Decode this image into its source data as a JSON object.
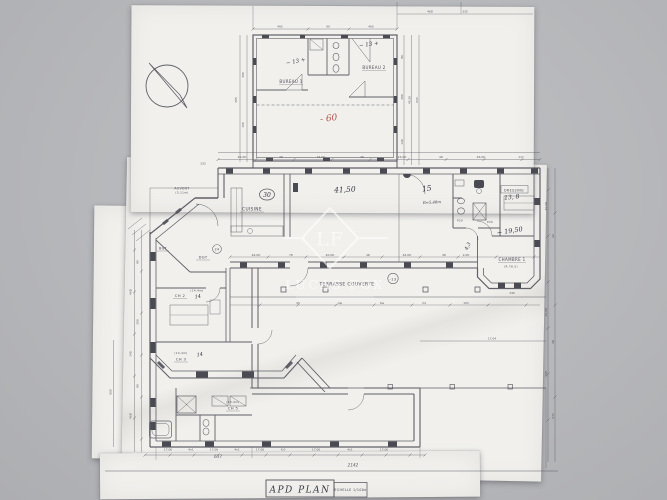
{
  "photo": {
    "background_color": "#b6b7ba",
    "paper_color": "#f1f0ed"
  },
  "ink": {
    "plan": "#54545c",
    "pen": "#333741",
    "red": "#b0544b"
  },
  "watermark": {
    "monogram": "LF",
    "brand": "LUCAS FOX"
  },
  "title_block": {
    "name": "APD  PLAN",
    "scale": "ECHELLE 1/100e"
  },
  "rooms": {
    "bureau1": "BUREAU 1",
    "bureau2": "BUREAU 2",
    "auvent": "AUVENT",
    "auvent_area": "(5,11m)",
    "cuisine": "CUISINE",
    "bgt": "BGT",
    "dgt": "DGT",
    "ch2": "CH 2",
    "ch2_area": "(14,4m)",
    "ch3": "CH 3",
    "ch3_area": "(14,4m)",
    "ch5": "CH 5",
    "ch5_area": "(13,4m)",
    "dressing": "DRESSING",
    "chambre1": "CHAMBRE 1",
    "chambre1_area": "(R.78,5)",
    "terrasse": "TERRASSE  COUVERTE",
    "p20": "P20"
  },
  "annotations": {
    "bureau1_area": "~ 13 +",
    "bureau2_area": "~ 13 +",
    "red_total": "- 60",
    "hall_circle": "30",
    "hall_total": "41,50",
    "bath_label": "15",
    "bath_width": "B=5,48m",
    "dressing_val": "13, 8",
    "right_total": "~ 19,50",
    "small_val": "4,3",
    "ch2_val": "14",
    "ch3_val": "14",
    "level_val": "-13",
    "entry_val": "24"
  },
  "dimensions": [
    {
      "t": "465",
      "x": 280,
      "y": 27.5
    },
    {
      "t": "90",
      "x": 328,
      "y": 27.5
    },
    {
      "t": "460",
      "x": 371,
      "y": 27.5
    },
    {
      "t": "335",
      "x": 465,
      "y": 12.5
    },
    {
      "t": "46D",
      "x": 430,
      "y": 12.5
    },
    {
      "t": "300",
      "x": 244,
      "y": 75,
      "r": -90
    },
    {
      "t": "150",
      "x": 244,
      "y": 125,
      "r": -90
    },
    {
      "t": "305",
      "x": 237,
      "y": 100,
      "r": -90
    },
    {
      "t": "90",
      "x": 403,
      "y": 57,
      "r": -90
    },
    {
      "t": "300",
      "x": 403,
      "y": 97,
      "r": -90
    },
    {
      "t": "140",
      "x": 403,
      "y": 142,
      "r": -90
    },
    {
      "t": "45,50",
      "x": 410.5,
      "y": 100,
      "r": -90
    },
    {
      "t": "643",
      "x": 418,
      "y": 100,
      "r": -90
    },
    {
      "t": "333",
      "x": 203,
      "y": 164.5
    },
    {
      "t": "46,0D",
      "x": 242,
      "y": 157.8
    },
    {
      "t": "4D",
      "x": 281,
      "y": 157.8
    },
    {
      "t": "34,0D",
      "x": 321,
      "y": 157.8
    },
    {
      "t": "4D",
      "x": 362,
      "y": 157.8
    },
    {
      "t": "24,0D",
      "x": 402,
      "y": 157.8
    },
    {
      "t": "4D",
      "x": 441,
      "y": 157.8
    },
    {
      "t": "46,0D",
      "x": 481,
      "y": 157.8
    },
    {
      "t": "117",
      "x": 521,
      "y": 157.8
    },
    {
      "t": "46,0D",
      "x": 256,
      "y": 255.8
    },
    {
      "t": "7D",
      "x": 291,
      "y": 255.8
    },
    {
      "t": "40,0D",
      "x": 330,
      "y": 255.8
    },
    {
      "t": "4D",
      "x": 368,
      "y": 255.8
    },
    {
      "t": "46,0D",
      "x": 407,
      "y": 255.8
    },
    {
      "t": "4D",
      "x": 444,
      "y": 255.8
    },
    {
      "t": "2,0D",
      "x": 466,
      "y": 255.8
    },
    {
      "t": "45",
      "x": 298,
      "y": 303.8
    },
    {
      "t": "4w",
      "x": 340,
      "y": 303.8
    },
    {
      "t": "6w",
      "x": 382,
      "y": 303.8
    },
    {
      "t": "24",
      "x": 424,
      "y": 303.8
    },
    {
      "t": "103",
      "x": 466,
      "y": 303.8
    },
    {
      "t": "17,04",
      "x": 492,
      "y": 339.5
    },
    {
      "t": "340",
      "x": 512,
      "y": 294
    },
    {
      "t": "90",
      "x": 138.5,
      "y": 262,
      "r": -90
    },
    {
      "t": "46D",
      "x": 131.5,
      "y": 292,
      "r": -90
    },
    {
      "t": "300",
      "x": 138.5,
      "y": 322,
      "r": -90
    },
    {
      "t": "140",
      "x": 131.5,
      "y": 354,
      "r": -90
    },
    {
      "t": "90",
      "x": 138.5,
      "y": 386,
      "r": -90
    },
    {
      "t": "46D",
      "x": 131.5,
      "y": 416,
      "r": -90
    },
    {
      "t": "600",
      "x": 111.5,
      "y": 392,
      "r": -90
    },
    {
      "t": "40,0D",
      "x": 547,
      "y": 206,
      "r": -90
    },
    {
      "t": "A0",
      "x": 554,
      "y": 236,
      "r": -90
    },
    {
      "t": "46,0D",
      "x": 547,
      "y": 312,
      "r": -90
    },
    {
      "t": "4D",
      "x": 554,
      "y": 342,
      "r": -90
    },
    {
      "t": "30D",
      "x": 547,
      "y": 374,
      "r": -90
    },
    {
      "t": "643",
      "x": 554,
      "y": 416,
      "r": -90
    },
    {
      "t": "17,06",
      "x": 168,
      "y": 450.5
    },
    {
      "t": "4x1",
      "x": 191,
      "y": 450.5
    },
    {
      "t": "17,06",
      "x": 214,
      "y": 450.5
    },
    {
      "t": "4x1",
      "x": 237,
      "y": 450.5
    },
    {
      "t": "17,06",
      "x": 260,
      "y": 450.5
    },
    {
      "t": "4,0",
      "x": 283,
      "y": 450.5
    },
    {
      "t": "17,06",
      "x": 316,
      "y": 450.5
    },
    {
      "t": "4x1",
      "x": 350,
      "y": 450.5
    },
    {
      "t": "17,06",
      "x": 384,
      "y": 450.5
    },
    {
      "t": "637",
      "x": 218,
      "y": 458,
      "big": true
    },
    {
      "t": "2142",
      "x": 353,
      "y": 466.5,
      "big": true
    }
  ]
}
